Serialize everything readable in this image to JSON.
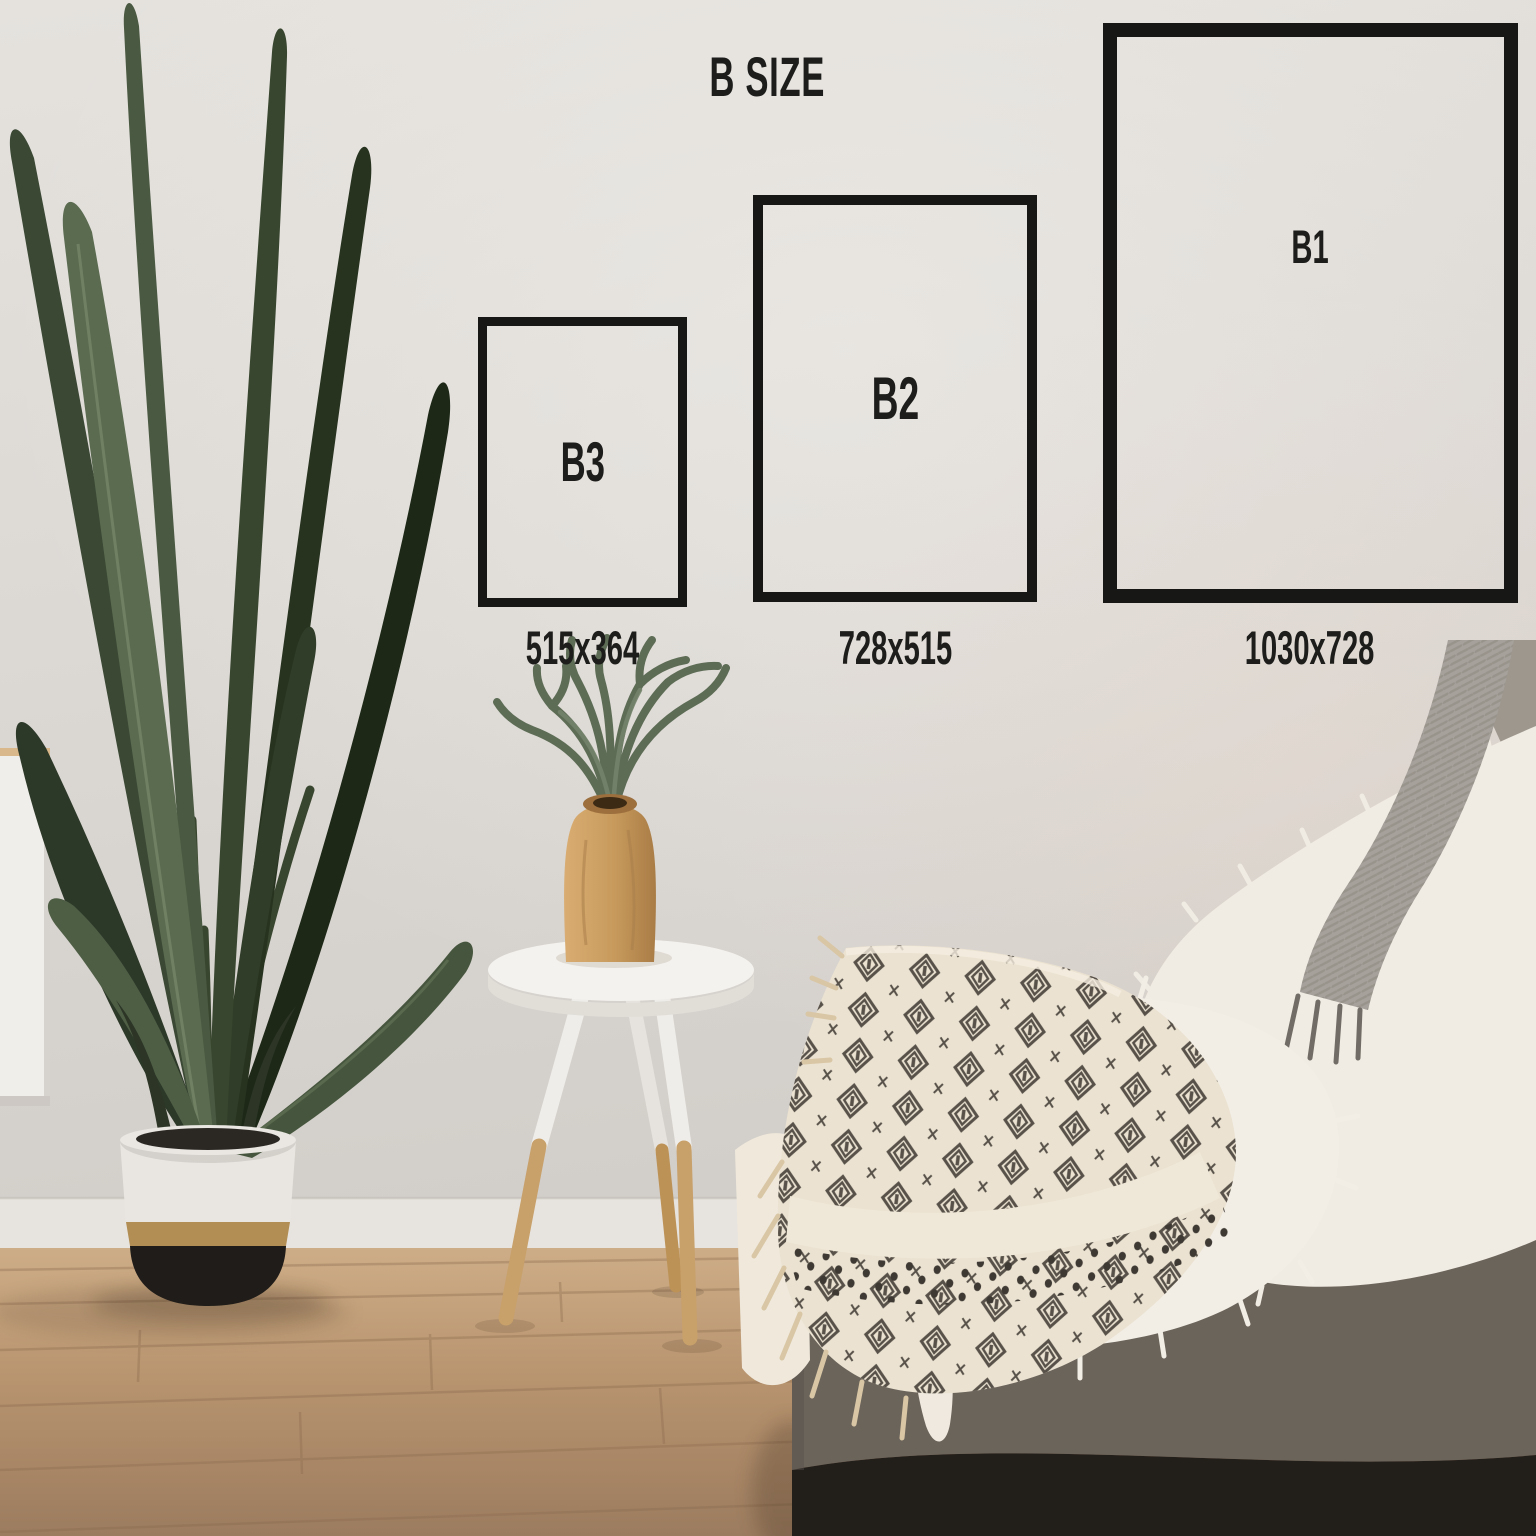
{
  "title": "B SIZE",
  "text_color": "#1d1d1b",
  "frame_border_color": "#171716",
  "frames": [
    {
      "id": "b3",
      "label": "B3",
      "dimensions": "515x364"
    },
    {
      "id": "b2",
      "label": "B2",
      "dimensions": "728x515"
    },
    {
      "id": "b1",
      "label": "B1",
      "dimensions": "1030x728"
    }
  ],
  "scene": {
    "description": "bright living room: tall bird-of-paradise plant in two-tone pot, white tripod side table with wooden vase and fern, grey daybed with fur pillow, knit band, sheepskin and patterned throw",
    "objects": [
      "wall",
      "baseboard",
      "wood-floor",
      "white-cabinet",
      "bird-of-paradise-plant",
      "two-tone-planter-pot",
      "tripod-side-table",
      "wooden-vase",
      "staghorn-fern",
      "grey-daybed",
      "corner-cushion",
      "grey-knit-band",
      "white-fur-pillow",
      "sheepskin-blanket",
      "patterned-throw-blanket"
    ],
    "palette": {
      "wall": "#ddd9d5",
      "floor": "#bb9a78",
      "leaf_green": "#5a6b50",
      "leaf_dark": "#1d2817",
      "pot_white": "#e9e6e1",
      "pot_gold": "#b28e55",
      "pot_black": "#1f1c19",
      "table_white": "#f4f2ee",
      "vase_wood": "#c99f63",
      "couch_grey": "#867e73",
      "couch_front": "#6b645b",
      "couch_base_dark": "#221e1a",
      "cushion_grey": "#a6a19b",
      "fur_white": "#f0ebe3",
      "throw_cream": "#ebe2d1",
      "throw_motif": "#46413a",
      "fringe": "#d9c6a4"
    }
  }
}
